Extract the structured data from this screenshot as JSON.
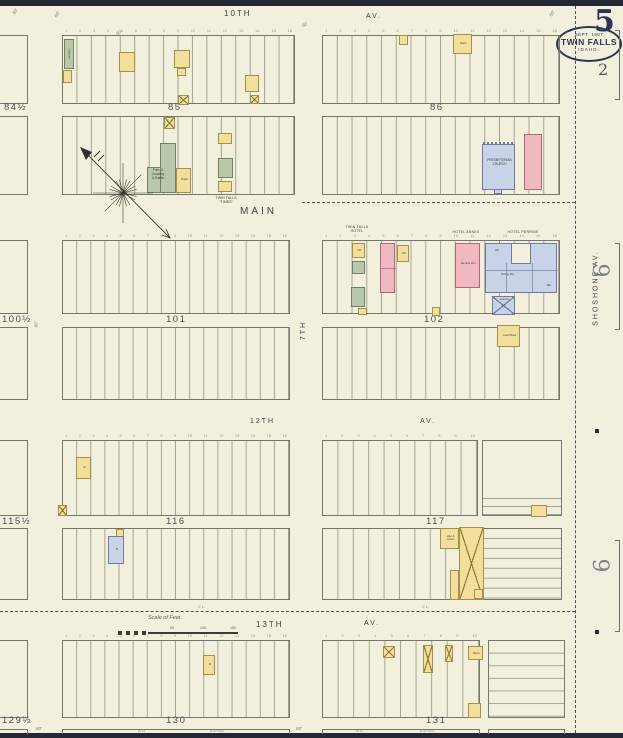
{
  "sheet": {
    "number": "5",
    "page_ref": "2",
    "badge": {
      "date": "SEPT. 1907",
      "city": "TWIN FALLS",
      "state": "IDAHO."
    },
    "adjacent_upper": "6",
    "adjacent_lower": "6"
  },
  "streets": {
    "s10": "10TH",
    "s10av": "AV.",
    "main": "MAIN",
    "s7": "7TH",
    "s12": "12TH",
    "s12av": "AV.",
    "s13": "13TH",
    "s13av": "AV.",
    "shoshone": "SHOSHONE AV."
  },
  "blocks": {
    "b84": "84½",
    "b85": "85",
    "b86": "86",
    "b100": "100½",
    "b101": "101",
    "b102": "102",
    "b115": "115½",
    "b116": "116",
    "b117": "117",
    "b129": "129½",
    "b130": "130",
    "b131": "131"
  },
  "annotations": {
    "city_limit": "C.L.",
    "no": "N O",
    "expos": "EXPOS.",
    "d50": "50'",
    "d60": "60'"
  },
  "scale_bar": {
    "title": "Scale of Feet.",
    "t50": "50",
    "t100": "100",
    "t150": "150"
  },
  "buildings": {
    "laundry": "Laundry",
    "store": {
      "l1": "Furn. &",
      "l2": "Crockery",
      "l3": "& Paints"
    },
    "paint": "Paint",
    "times": {
      "l1": "TWIN FALLS",
      "l2": "“TIMES”"
    },
    "barn_86": "Barn",
    "church": {
      "l1": "PRESBYTERIAN",
      "l2": "CHURCH"
    },
    "hotels": {
      "twin_falls": "TWIN FALLS HOTEL",
      "annex": "HOTEL ANNEX",
      "perrine": "HOTEL PERRINE"
    },
    "off": "Off.",
    "sample_rm": "Sample Rm.",
    "dining": "Dining Rm.",
    "bar": "Bar",
    "laundry_rear": "Laundry",
    "coal_shed": "Coal Shed",
    "hay": {
      "l1": "Hay &",
      "l2": "Feed"
    },
    "barn_131": "Barn",
    "dwelling": "D"
  },
  "palette": {
    "paper": "#f3efdd",
    "ink": "#4a4e46",
    "navy": "#2b3450",
    "dwelling_yellow": "#f2df9b",
    "brick_pink": "#f0b9c0",
    "special_blue": "#c8d3e8",
    "shop_green": "#b9c8aa",
    "edge_bar": "#232834"
  }
}
